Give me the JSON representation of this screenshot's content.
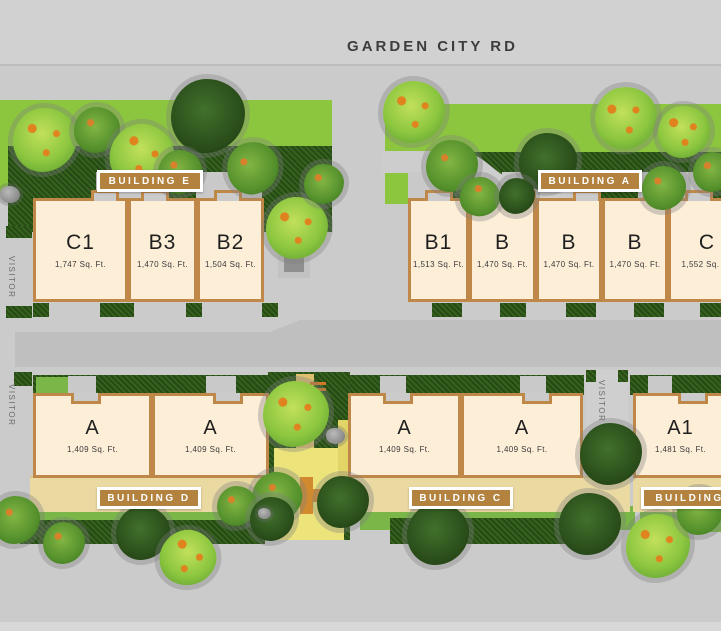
{
  "road": {
    "title": "GARDEN CITY RD"
  },
  "visitor_labels": [
    "VISITOR",
    "VISITOR",
    "VISITOR"
  ],
  "buildings": [
    {
      "label": "BUILDING E",
      "units": [
        {
          "name": "C1",
          "area": "1,747 Sq. Ft."
        },
        {
          "name": "B3",
          "area": "1,470 Sq. Ft."
        },
        {
          "name": "B2",
          "area": "1,504 Sq. Ft."
        }
      ]
    },
    {
      "label": "BUILDING A",
      "units": [
        {
          "name": "B1",
          "area": "1,513 Sq. Ft."
        },
        {
          "name": "B",
          "area": "1,470 Sq. Ft."
        },
        {
          "name": "B",
          "area": "1,470 Sq. Ft."
        },
        {
          "name": "B",
          "area": "1,470 Sq. Ft."
        },
        {
          "name": "C",
          "area": "1,552 Sq. Ft."
        }
      ]
    },
    {
      "label": "BUILDING D",
      "units": [
        {
          "name": "A",
          "area": "1,409 Sq. Ft."
        },
        {
          "name": "A",
          "area": "1,409 Sq. Ft."
        }
      ]
    },
    {
      "label": "BUILDING C",
      "units": [
        {
          "name": "A",
          "area": "1,409 Sq. Ft."
        },
        {
          "name": "A",
          "area": "1,409 Sq. Ft."
        }
      ]
    },
    {
      "label": "BUILDING B",
      "units": [
        {
          "name": "A1",
          "area": "1,481 Sq. Ft."
        }
      ]
    }
  ],
  "colors": {
    "badge": "#b3823e",
    "unit_fill": "#fdeed8",
    "unit_border": "#c08848",
    "lawn": "#8cc63f",
    "hedge": "#2e591b",
    "road": "#bfbfbf",
    "walkway": "#ead9a1",
    "plaza": "#ece37b"
  }
}
